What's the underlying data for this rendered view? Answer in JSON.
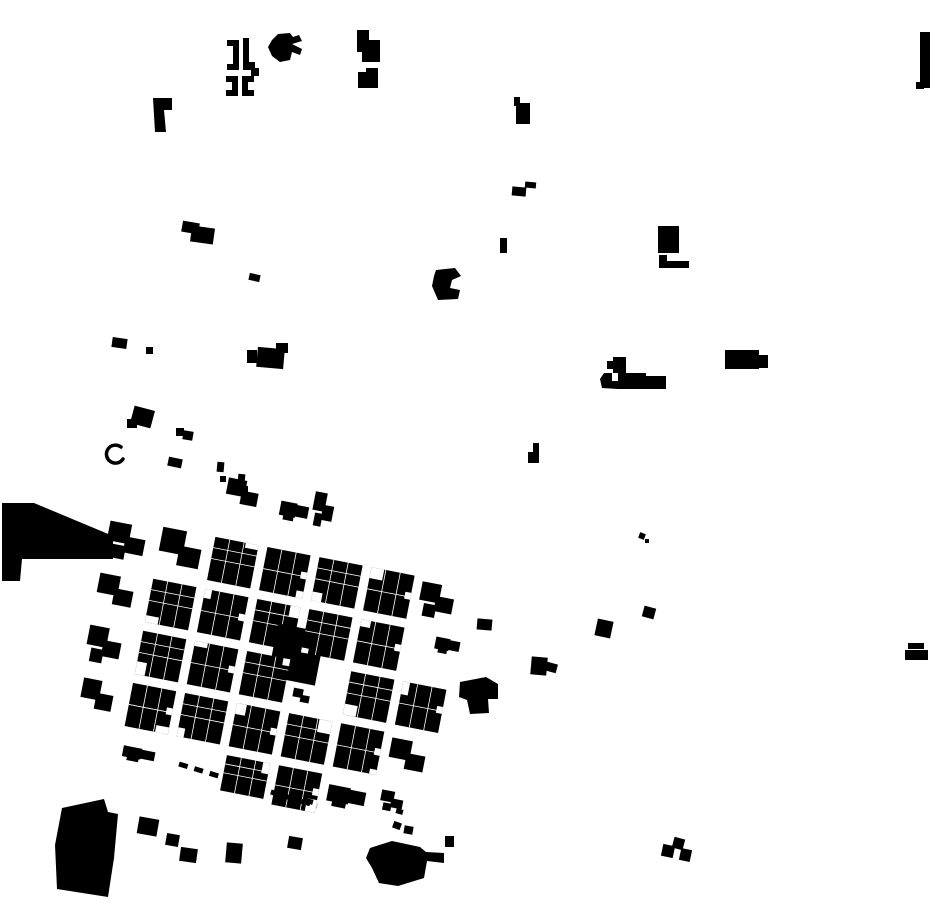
{
  "map": {
    "background": "#ffffff",
    "ink": "#000000",
    "canvas": {
      "width": 930,
      "height": 924
    },
    "town": {
      "rotation_deg": 11,
      "pivot": {
        "x": 330,
        "y": 660
      },
      "block_pitch_px": 53,
      "street_gap_px": 9,
      "blocks": [
        {
          "x": 284,
          "y": 497,
          "w": 22,
          "h": 34,
          "style": "sparse"
        },
        {
          "x": 196,
          "y": 500,
          "w": 34,
          "h": 30,
          "style": "sparse"
        },
        {
          "x": 252,
          "y": 505,
          "w": 30,
          "h": 26,
          "style": "sparse"
        },
        {
          "x": 88,
          "y": 565,
          "w": 40,
          "h": 36,
          "style": "sparse"
        },
        {
          "x": 141,
          "y": 561,
          "w": 44,
          "h": 44,
          "style": "sparse"
        },
        {
          "x": 194,
          "y": 561,
          "w": 44,
          "h": 44,
          "style": "parcels"
        },
        {
          "x": 247,
          "y": 561,
          "w": 44,
          "h": 44,
          "style": "parcels"
        },
        {
          "x": 300,
          "y": 561,
          "w": 44,
          "h": 44,
          "style": "parcels"
        },
        {
          "x": 353,
          "y": 561,
          "w": 44,
          "h": 44,
          "style": "parcels"
        },
        {
          "x": 406,
          "y": 565,
          "w": 36,
          "h": 34,
          "style": "sparse"
        },
        {
          "x": 88,
          "y": 618,
          "w": 38,
          "h": 36,
          "style": "sparse"
        },
        {
          "x": 141,
          "y": 614,
          "w": 44,
          "h": 44,
          "style": "parcels"
        },
        {
          "x": 194,
          "y": 614,
          "w": 44,
          "h": 44,
          "style": "parcels"
        },
        {
          "x": 247,
          "y": 614,
          "w": 44,
          "h": 44,
          "style": "parcels"
        },
        {
          "x": 272,
          "y": 634,
          "w": 48,
          "h": 54,
          "style": "solid"
        },
        {
          "x": 300,
          "y": 614,
          "w": 44,
          "h": 44,
          "style": "parcels"
        },
        {
          "x": 353,
          "y": 614,
          "w": 44,
          "h": 44,
          "style": "parcels"
        },
        {
          "x": 430,
          "y": 610,
          "w": 26,
          "h": 22,
          "style": "sparse"
        },
        {
          "x": 88,
          "y": 671,
          "w": 36,
          "h": 36,
          "style": "sparse"
        },
        {
          "x": 141,
          "y": 667,
          "w": 44,
          "h": 44,
          "style": "parcels"
        },
        {
          "x": 194,
          "y": 667,
          "w": 44,
          "h": 44,
          "style": "parcels"
        },
        {
          "x": 247,
          "y": 667,
          "w": 44,
          "h": 44,
          "style": "parcels"
        },
        {
          "x": 300,
          "y": 694,
          "w": 18,
          "h": 16,
          "style": "sparse"
        },
        {
          "x": 353,
          "y": 667,
          "w": 44,
          "h": 44,
          "style": "parcels"
        },
        {
          "x": 406,
          "y": 667,
          "w": 44,
          "h": 44,
          "style": "parcels"
        },
        {
          "x": 92,
          "y": 724,
          "w": 34,
          "h": 36,
          "style": "sparse"
        },
        {
          "x": 141,
          "y": 720,
          "w": 44,
          "h": 44,
          "style": "parcels"
        },
        {
          "x": 194,
          "y": 720,
          "w": 44,
          "h": 44,
          "style": "parcels"
        },
        {
          "x": 247,
          "y": 720,
          "w": 44,
          "h": 44,
          "style": "parcels"
        },
        {
          "x": 300,
          "y": 720,
          "w": 44,
          "h": 44,
          "style": "parcels"
        },
        {
          "x": 353,
          "y": 720,
          "w": 44,
          "h": 44,
          "style": "parcels"
        },
        {
          "x": 406,
          "y": 724,
          "w": 38,
          "h": 36,
          "style": "sparse"
        },
        {
          "x": 144,
          "y": 777,
          "w": 34,
          "h": 20,
          "style": "sparse"
        },
        {
          "x": 247,
          "y": 773,
          "w": 44,
          "h": 36,
          "style": "parcels"
        },
        {
          "x": 300,
          "y": 773,
          "w": 44,
          "h": 40,
          "style": "parcels"
        },
        {
          "x": 353,
          "y": 773,
          "w": 40,
          "h": 30,
          "style": "sparse"
        },
        {
          "x": 406,
          "y": 777,
          "w": 24,
          "h": 20,
          "style": "sparse"
        }
      ]
    },
    "trail": {
      "x1": 179,
      "y1": 764,
      "x2": 317,
      "y2": 806,
      "stroke_width": 5,
      "dash": "9 7"
    },
    "outliers": [
      {
        "type": "poly",
        "points": "227,40 239,40 239,70 227,70 227,64 233,64 233,46 227,46"
      },
      {
        "type": "poly",
        "points": "243,38 249,38 249,62 255,62 255,70 243,70"
      },
      {
        "type": "poly",
        "points": "226,76 238,76 238,96 226,96 226,90 232,90 232,82 226,82"
      },
      {
        "type": "poly",
        "points": "242,76 254,76 254,82 248,82 248,90 254,90 254,96 242,96"
      },
      {
        "type": "rect",
        "x": 251,
        "y": 68,
        "w": 8,
        "h": 8
      },
      {
        "type": "poly",
        "points": "272,40 278,34 290,33 293,37 299,35 302,41 292,44 302,49 300,55 292,52 290,60 280,62 272,56 268,47"
      },
      {
        "type": "poly",
        "points": "357,30 369,30 369,40 380,40 380,62 362,62 362,52 357,52"
      },
      {
        "type": "poly",
        "points": "358,72 366,72 366,68 378,68 378,88 358,88"
      },
      {
        "type": "poly",
        "points": "153,98 172,98 172,110 164,110 166,132 155,132"
      },
      {
        "type": "poly",
        "points": "514,97 520,97 520,103 530,103 530,124 516,124 516,106 514,106"
      },
      {
        "type": "rect",
        "x": 920,
        "y": 32,
        "w": 10,
        "h": 56
      },
      {
        "type": "rect",
        "x": 916,
        "y": 82,
        "w": 8,
        "h": 7
      },
      {
        "type": "rect",
        "x": 512,
        "y": 187,
        "w": 14,
        "h": 9,
        "rot": 5
      },
      {
        "type": "rect",
        "x": 525,
        "y": 182,
        "w": 11,
        "h": 6,
        "rot": 5
      },
      {
        "type": "rect",
        "x": 182,
        "y": 222,
        "w": 17,
        "h": 11,
        "rot": 10
      },
      {
        "type": "rect",
        "x": 191,
        "y": 227,
        "w": 23,
        "h": 16,
        "rot": 8
      },
      {
        "type": "rect",
        "x": 500,
        "y": 238,
        "w": 7,
        "h": 15
      },
      {
        "type": "rect",
        "x": 658,
        "y": 226,
        "w": 21,
        "h": 27
      },
      {
        "type": "poly",
        "points": "659,255 667,255 667,261 689,261 689,268 659,268"
      },
      {
        "type": "rect",
        "x": 249,
        "y": 274,
        "w": 11,
        "h": 7,
        "rot": 12
      },
      {
        "type": "poly",
        "points": "436,270 455,268 461,276 452,280 450,288 460,290 458,299 438,300 432,286 434,276"
      },
      {
        "type": "rect",
        "x": 112,
        "y": 338,
        "w": 15,
        "h": 10,
        "rot": 8
      },
      {
        "type": "rect",
        "x": 146,
        "y": 347,
        "w": 7,
        "h": 7
      },
      {
        "type": "rect",
        "x": 247,
        "y": 350,
        "w": 10,
        "h": 13
      },
      {
        "type": "rect",
        "x": 257,
        "y": 348,
        "w": 27,
        "h": 20,
        "rot": 5
      },
      {
        "type": "rect",
        "x": 276,
        "y": 343,
        "w": 12,
        "h": 10
      },
      {
        "type": "rect",
        "x": 725,
        "y": 350,
        "w": 34,
        "h": 19
      },
      {
        "type": "rect",
        "x": 757,
        "y": 355,
        "w": 11,
        "h": 13
      },
      {
        "type": "rect",
        "x": 607,
        "y": 361,
        "w": 8,
        "h": 8
      },
      {
        "type": "rect",
        "x": 613,
        "y": 357,
        "w": 13,
        "h": 16
      },
      {
        "type": "poly",
        "points": "618,373 646,373 646,376 666,376 666,389 618,389"
      },
      {
        "type": "poly",
        "points": "604,373 612,373 612,381 618,381 618,389 602,388 600,379"
      },
      {
        "type": "rect",
        "x": 132,
        "y": 408,
        "w": 21,
        "h": 18,
        "rot": 15
      },
      {
        "type": "rect",
        "x": 127,
        "y": 419,
        "w": 10,
        "h": 9
      },
      {
        "type": "rect",
        "x": 176,
        "y": 428,
        "w": 8,
        "h": 8
      },
      {
        "type": "rect",
        "x": 183,
        "y": 431,
        "w": 10,
        "h": 9,
        "rot": 10
      },
      {
        "type": "path",
        "d": "M 121,447 A 9,9 0 1 0 123,459",
        "stroke_width": 3.5
      },
      {
        "type": "rect",
        "x": 168,
        "y": 458,
        "w": 14,
        "h": 9,
        "rot": 12
      },
      {
        "type": "rect",
        "x": 217,
        "y": 462,
        "w": 7,
        "h": 10,
        "rot": 5
      },
      {
        "type": "rect",
        "x": 220,
        "y": 476,
        "w": 6,
        "h": 6
      },
      {
        "type": "rect",
        "x": 238,
        "y": 474,
        "w": 7,
        "h": 9,
        "rot": 5
      },
      {
        "type": "rect",
        "x": 242,
        "y": 486,
        "w": 6,
        "h": 6
      },
      {
        "type": "poly",
        "points": "533,443 539,443 539,463 528,463 528,452 533,452"
      },
      {
        "type": "poly",
        "points": "2,503 34,503 113,536 113,559 22,559 20,581 2,581"
      },
      {
        "type": "rect",
        "x": 639,
        "y": 533,
        "w": 6,
        "h": 6,
        "rot": 20
      },
      {
        "type": "rect",
        "x": 645,
        "y": 539,
        "w": 4,
        "h": 4
      },
      {
        "type": "rect",
        "x": 643,
        "y": 607,
        "w": 12,
        "h": 11,
        "rot": 15
      },
      {
        "type": "rect",
        "x": 596,
        "y": 620,
        "w": 16,
        "h": 17,
        "rot": 12
      },
      {
        "type": "rect",
        "x": 531,
        "y": 657,
        "w": 16,
        "h": 18,
        "rot": 5
      },
      {
        "type": "rect",
        "x": 546,
        "y": 663,
        "w": 11,
        "h": 9,
        "rot": 15
      },
      {
        "type": "rect",
        "x": 477,
        "y": 619,
        "w": 15,
        "h": 11,
        "rot": 5
      },
      {
        "type": "poly",
        "points": "460,682 486,677 498,684 498,699 488,699 489,713 470,714 467,700 459,697"
      },
      {
        "type": "rect",
        "x": 908,
        "y": 643,
        "w": 16,
        "h": 6
      },
      {
        "type": "rect",
        "x": 905,
        "y": 650,
        "w": 23,
        "h": 10
      },
      {
        "type": "poly",
        "points": "62,808 104,799 108,812 118,814 114,858 108,897 57,889 55,845"
      },
      {
        "type": "rect",
        "x": 138,
        "y": 818,
        "w": 20,
        "h": 17,
        "rot": 10
      },
      {
        "type": "rect",
        "x": 166,
        "y": 834,
        "w": 13,
        "h": 12,
        "rot": 10
      },
      {
        "type": "rect",
        "x": 180,
        "y": 848,
        "w": 17,
        "h": 14,
        "rot": 8
      },
      {
        "type": "rect",
        "x": 226,
        "y": 843,
        "w": 16,
        "h": 20,
        "rot": 5
      },
      {
        "type": "rect",
        "x": 288,
        "y": 837,
        "w": 14,
        "h": 12,
        "rot": 10
      },
      {
        "type": "rect",
        "x": 292,
        "y": 799,
        "w": 9,
        "h": 6,
        "rot": 15
      },
      {
        "type": "rect",
        "x": 306,
        "y": 799,
        "w": 7,
        "h": 5,
        "rot": 15
      },
      {
        "type": "poly",
        "points": "370,848 392,841 420,847 426,852 444,853 444,863 427,861 424,878 398,886 379,883 372,868 366,858"
      },
      {
        "type": "rect",
        "x": 393,
        "y": 822,
        "w": 8,
        "h": 7,
        "rot": 20
      },
      {
        "type": "rect",
        "x": 404,
        "y": 826,
        "w": 9,
        "h": 8,
        "rot": 10
      },
      {
        "type": "rect",
        "x": 445,
        "y": 836,
        "w": 9,
        "h": 11
      },
      {
        "type": "rect",
        "x": 396,
        "y": 809,
        "w": 7,
        "h": 5,
        "rot": 15
      },
      {
        "type": "rect",
        "x": 662,
        "y": 845,
        "w": 12,
        "h": 12,
        "rot": 12
      },
      {
        "type": "rect",
        "x": 673,
        "y": 838,
        "w": 11,
        "h": 11,
        "rot": 15
      },
      {
        "type": "rect",
        "x": 680,
        "y": 849,
        "w": 11,
        "h": 12,
        "rot": 12
      }
    ]
  }
}
